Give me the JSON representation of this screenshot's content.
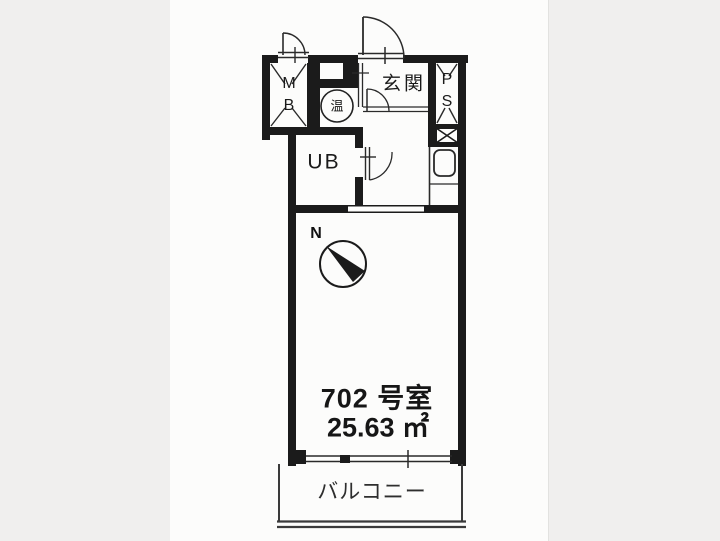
{
  "floorplan": {
    "unit_number": "702 号室",
    "area": "25.63 ㎡",
    "rooms": {
      "entrance": "玄関",
      "unit_bath": "UB",
      "balcony": "バルコニー",
      "water_heater": "温"
    },
    "closets": {
      "meter_box_line1": "M",
      "meter_box_line2": "B",
      "pipe_space_line1": "P",
      "pipe_space_line2": "S"
    },
    "compass": {
      "north_label": "N"
    },
    "colors": {
      "wall": "#1b1b1b",
      "line": "#2a2a2a",
      "paper": "#fcfcfb",
      "background": "#f0efee"
    }
  }
}
